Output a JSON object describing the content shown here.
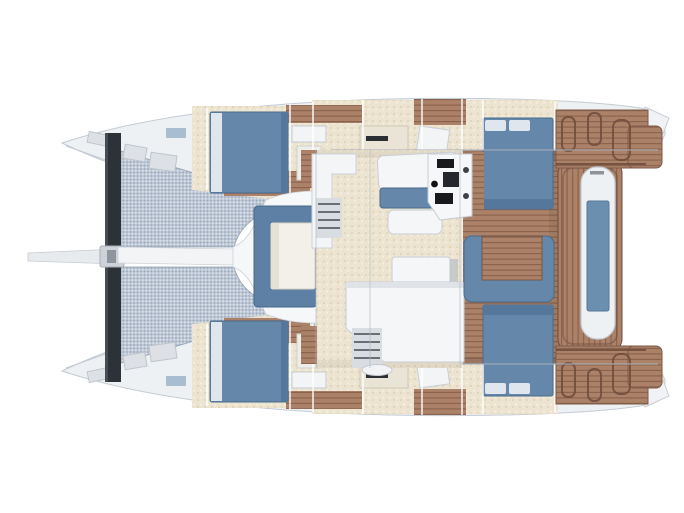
{
  "colors": {
    "background": "#ffffff",
    "hull_shell": "#eef1f4",
    "hull_stroke": "#c5cbd3",
    "hull_inner_shadow": "#aab2bc",
    "beam_dark": "#2c3237",
    "beam_edge": "#454c53",
    "bowsprit": "#e8ebee",
    "fitting_gray": "#ced3d9",
    "fitting_dark": "#8f959d",
    "mesh_bg": "#bfc9d6",
    "mesh_dot_dark": "#94a3b6",
    "mesh_dot_light": "#e9eef4",
    "cream_bg": "#ece4d0",
    "cream_speck_dark": "#e0d5ba",
    "cream_speck_light": "#f6f0df",
    "teak": "#ab8168",
    "teak_line": "#8c634e",
    "teak_seam": "#6d4c3b",
    "teak_edge": "#7c5a47",
    "cushion_blue": "#6487aa",
    "cushion_blue_dark": "#55779b",
    "cushion_stroke": "#4a6b8d",
    "pillow_white": "#dfe6ee",
    "hatch_frame": "#5d80a4",
    "hatch_frame_stroke": "#47688c",
    "hatch_inner": "#f2f0e8",
    "hatch_inner_stroke": "#d6d2c4",
    "capsule_white": "#eef1f4",
    "capsule_insert": "#6b8fae",
    "capsule_insert_stroke": "#54789a",
    "furniture_white": "#f4f6f8",
    "furniture_stroke": "#c9ced6",
    "furniture_shadow": "#b9bfc8",
    "walkway_white": "#f2f4f6",
    "fan_white": "#f5f7f9",
    "steps_bg": "#d9dde2",
    "steps_line": "#6a6f76",
    "instrument_black": "#17191d",
    "instrument_gray": "#24272c",
    "knob_gray": "#3c4148",
    "window_blue": "#a9bcd0",
    "box_gray": "#dde1e6",
    "box_stroke": "#bfc5cc",
    "glass_line": "#aeb6c0",
    "white_tip": "#f0f2f5"
  }
}
